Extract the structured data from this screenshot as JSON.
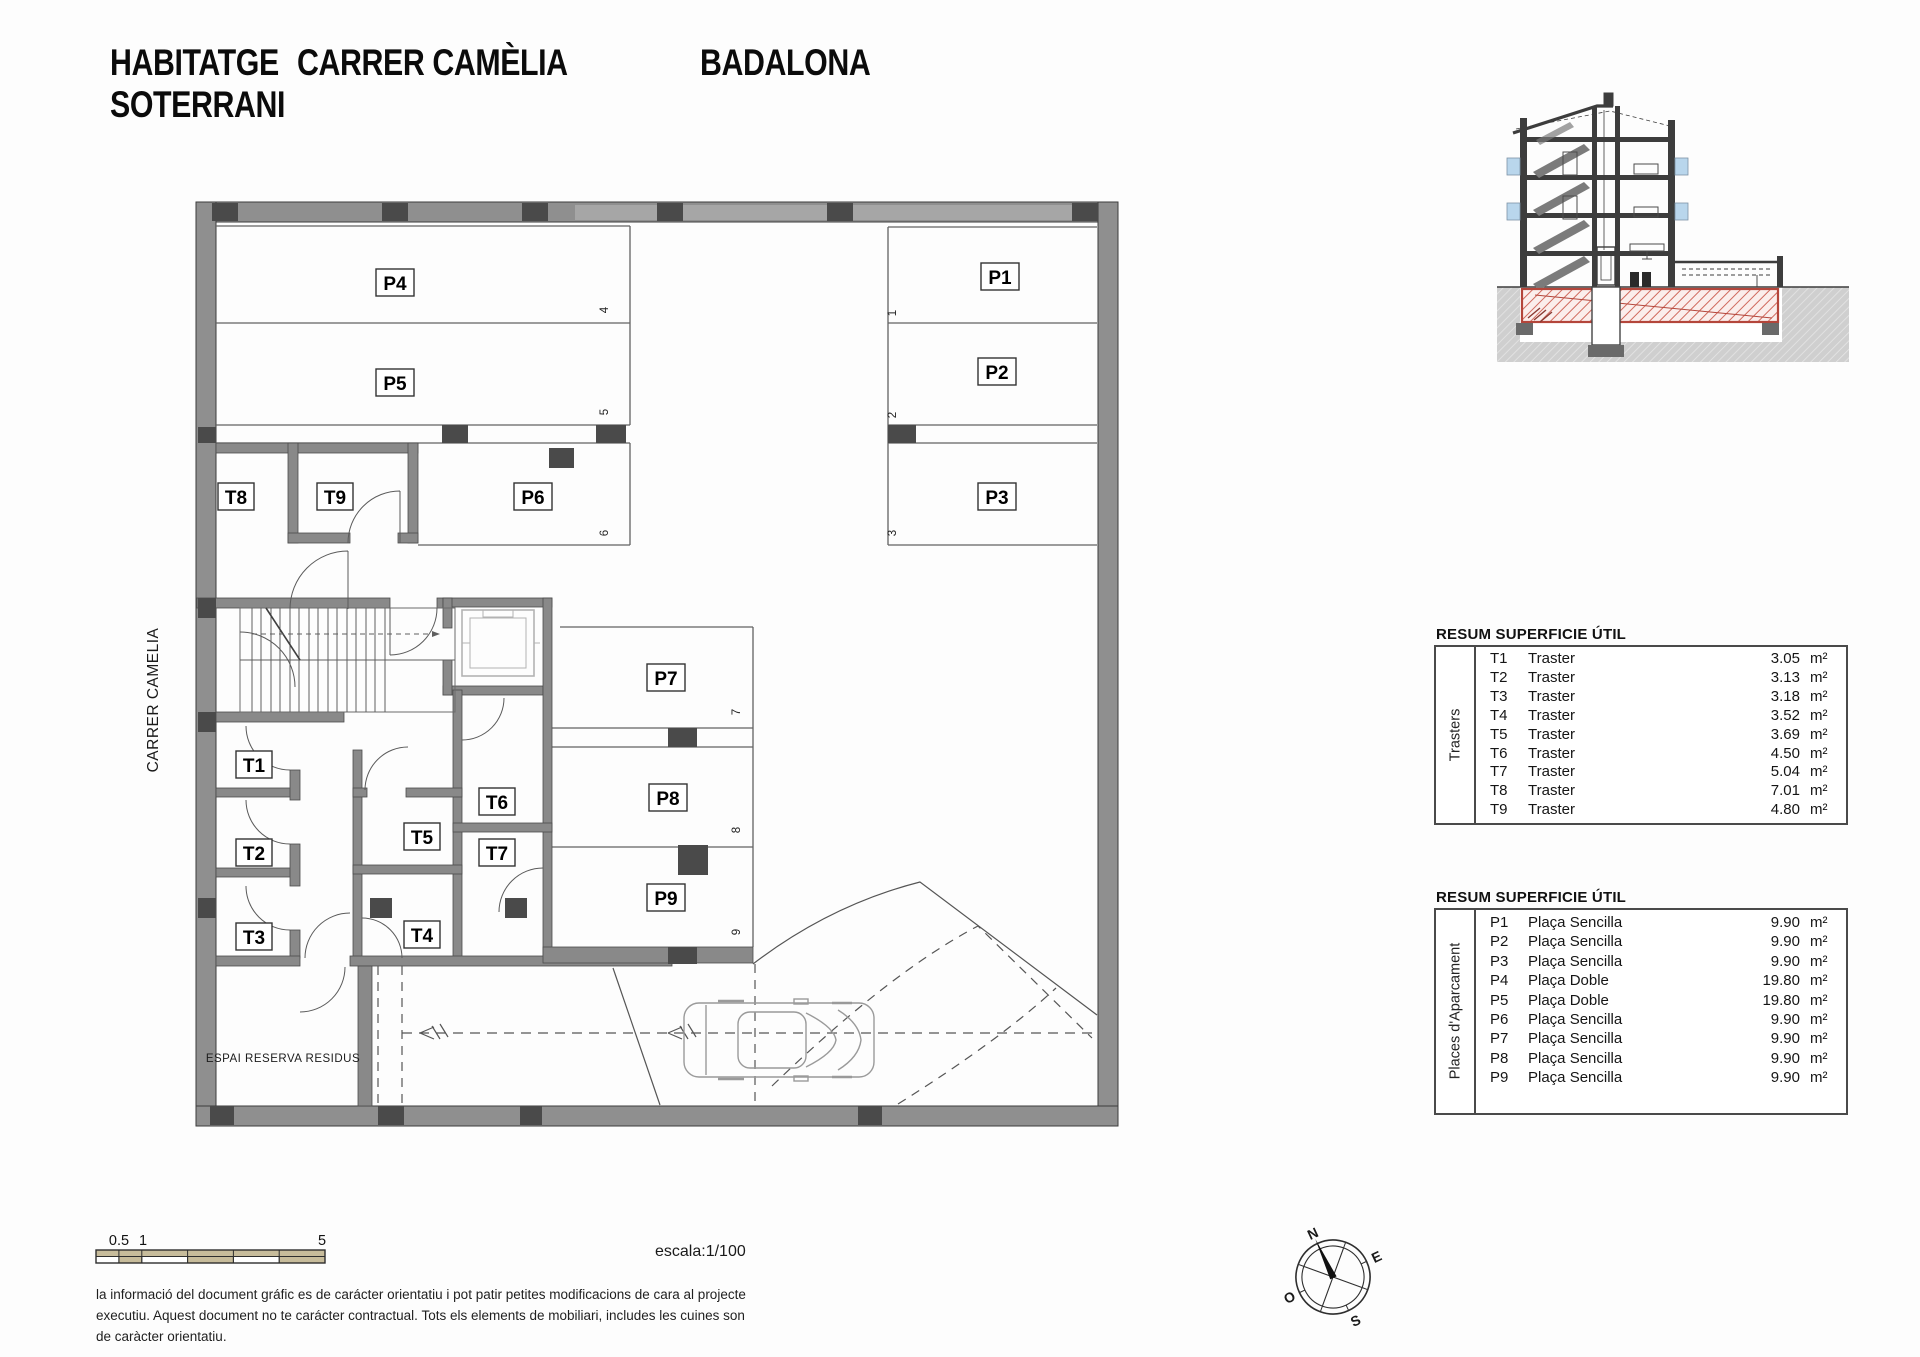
{
  "header": {
    "project_line1": "HABITATGE",
    "project_line2": "SOTERRANI",
    "street": "CARRER CAMÈLIA",
    "city": "BADALONA"
  },
  "plan": {
    "street_label": "CARRER CAMELIA",
    "residus_label": "ESPAI RESERVA RESIDUS",
    "p1": "P1",
    "p2": "P2",
    "p3": "P3",
    "p4": "P4",
    "p5": "P5",
    "p6": "P6",
    "p7": "P7",
    "p8": "P8",
    "p9": "P9",
    "t1": "T1",
    "t2": "T2",
    "t3": "T3",
    "t4": "T4",
    "t5": "T5",
    "t6": "T6",
    "t7": "T7",
    "t8": "T8",
    "t9": "T9",
    "n1": "1",
    "n2": "2",
    "n3": "3",
    "n4": "4",
    "n5": "5",
    "n6": "6",
    "n7": "7",
    "n8": "8",
    "n9": "9"
  },
  "tables": [
    {
      "title": "RESUM SUPERFICIE ÚTIL",
      "side_label": "Trasters",
      "rows": [
        {
          "code": "T1",
          "name": "Traster",
          "value": "3.05",
          "unit": "m²"
        },
        {
          "code": "T2",
          "name": "Traster",
          "value": "3.13",
          "unit": "m²"
        },
        {
          "code": "T3",
          "name": "Traster",
          "value": "3.18",
          "unit": "m²"
        },
        {
          "code": "T4",
          "name": "Traster",
          "value": "3.52",
          "unit": "m²"
        },
        {
          "code": "T5",
          "name": "Traster",
          "value": "3.69",
          "unit": "m²"
        },
        {
          "code": "T6",
          "name": "Traster",
          "value": "4.50",
          "unit": "m²"
        },
        {
          "code": "T7",
          "name": "Traster",
          "value": "5.04",
          "unit": "m²"
        },
        {
          "code": "T8",
          "name": "Traster",
          "value": "7.01",
          "unit": "m²"
        },
        {
          "code": "T9",
          "name": "Traster",
          "value": "4.80",
          "unit": "m²"
        }
      ]
    },
    {
      "title": "RESUM SUPERFICIE ÚTIL",
      "side_label": "Places d'Aparcament",
      "rows": [
        {
          "code": "P1",
          "name": "Plaça Sencilla",
          "value": "9.90",
          "unit": "m²"
        },
        {
          "code": "P2",
          "name": "Plaça Sencilla",
          "value": "9.90",
          "unit": "m²"
        },
        {
          "code": "P3",
          "name": "Plaça Sencilla",
          "value": "9.90",
          "unit": "m²"
        },
        {
          "code": "P4",
          "name": "Plaça Doble",
          "value": "19.80",
          "unit": "m²"
        },
        {
          "code": "P5",
          "name": "Plaça Doble",
          "value": "19.80",
          "unit": "m²"
        },
        {
          "code": "P6",
          "name": "Plaça Sencilla",
          "value": "9.90",
          "unit": "m²"
        },
        {
          "code": "P7",
          "name": "Plaça Sencilla",
          "value": "9.90",
          "unit": "m²"
        },
        {
          "code": "P8",
          "name": "Plaça Sencilla",
          "value": "9.90",
          "unit": "m²"
        },
        {
          "code": "P9",
          "name": "Plaça Sencilla",
          "value": "9.90",
          "unit": "m²"
        }
      ]
    }
  ],
  "scale": {
    "l05": "0.5",
    "l1": "1",
    "l5": "5",
    "text": "escala:1/100"
  },
  "compass": {
    "n": "N",
    "e": "E",
    "s": "S",
    "o": "O"
  },
  "disclaimer": {
    "l1": "la informació del document gráfic es de carácter orientatiu i pot patir petites modificacions de cara al projecte",
    "l2": "executiu. Aquest document no te carácter contractual. Tots els elements de mobiliari, includes les cuines son",
    "l3": "de caràcter orientatiu."
  },
  "colors": {
    "wall_gray": "#8f8f8f",
    "column_dark": "#4a4a4a",
    "accent_red": "#b4463b",
    "scale_tan": "#c7bc9b",
    "window_blue": "#b9d6ec"
  }
}
